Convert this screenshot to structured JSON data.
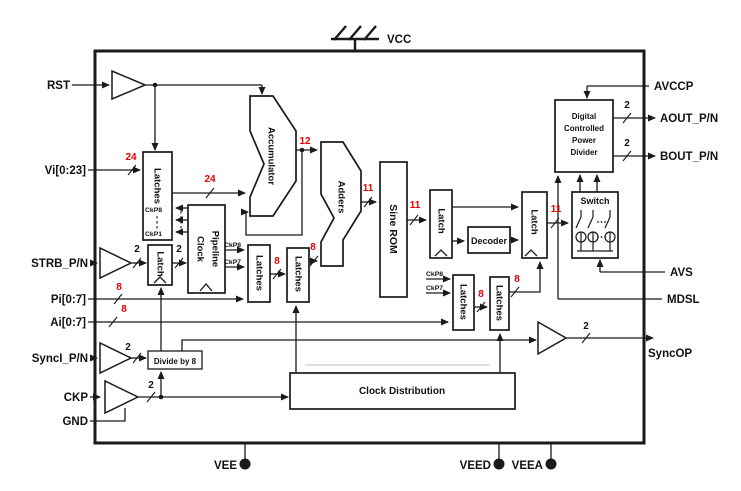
{
  "labels": {
    "vcc": "VCC",
    "rst": "RST",
    "vi": "Vi[0:23]",
    "strb": "STRB_P/N",
    "pi": "Pi[0:7]",
    "ai": "Ai[0:7]",
    "synci": "SyncI_P/N",
    "ckp": "CKP",
    "gnd": "GND",
    "avccp": "AVCCP",
    "aout": "AOUT_P/N",
    "bout": "BOUT_P/N",
    "avs": "AVS",
    "mdsl": "MDSL",
    "syncop": "SyncOP",
    "vee": "VEE",
    "veed": "VEED",
    "veea": "VEEA"
  },
  "blocks": {
    "latches": "Latches",
    "latch": "Latch",
    "accumulator": "Accumulator",
    "adders": "Adders",
    "sine_rom": "Sine ROM",
    "pipeline": "Pipeline",
    "clock": "Clock",
    "decoder": "Decoder",
    "dcpd_lines": [
      "Digital",
      "Controlled",
      "Power",
      "Divider"
    ],
    "switch": "Switch",
    "divide8": "Divide by 8",
    "clock_dist": "Clock Distribution"
  },
  "bus": {
    "b24": "24",
    "b12": "12",
    "b11": "11",
    "b8": "8",
    "b2": "2"
  },
  "clocks": {
    "ckp8": "CkP8",
    "ckp7": "CkP7",
    "ckp1": "CkP1"
  },
  "colors": {
    "bus_red": "#e60000",
    "line": "#1a1a1a"
  }
}
